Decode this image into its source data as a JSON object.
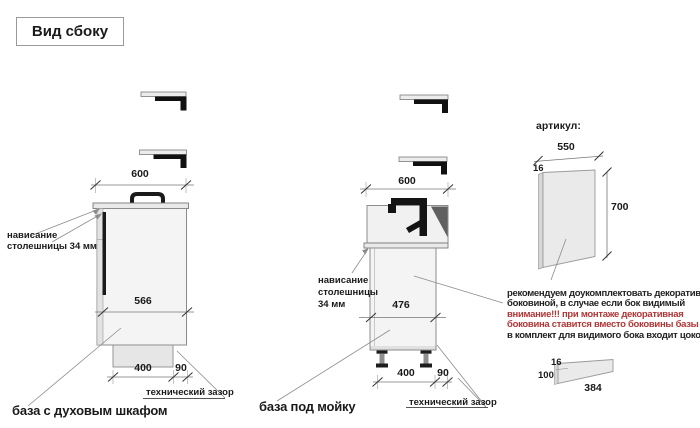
{
  "title": "Вид сбоку",
  "colors": {
    "warning_text": "#b03636",
    "drawing_outline": "#8c8c8c",
    "cabinet_fill": "#f4f4f4",
    "accent_black": "#1a1a1a"
  },
  "oven_base": {
    "label": "база с духовым шкафом",
    "dims": {
      "countertop_width": "600",
      "body_depth": "566",
      "plinth_depth": "400",
      "rear_gap": "90"
    },
    "overhang_note": {
      "line1": "нависание",
      "line2": "столешницы 34 мм"
    },
    "gap_label": "технический зазор"
  },
  "sink_base": {
    "label": "база под мойку",
    "dims": {
      "countertop_width": "600",
      "body_depth": "476",
      "plinth_depth": "400",
      "rear_gap": "90"
    },
    "overhang_note": {
      "line1": "нависание",
      "line2": "столешницы",
      "line3": "34 мм"
    },
    "gap_label": "технический зазор"
  },
  "side_panel": {
    "header": "артикул:",
    "dims": {
      "width": "550",
      "thickness": "16",
      "height": "700"
    }
  },
  "plinth_strip": {
    "dims": {
      "thickness": "16",
      "height": "100",
      "length": "384"
    }
  },
  "note": {
    "lines": [
      {
        "text": "рекомендуем доукомплектовать декоративной",
        "style": "normal"
      },
      {
        "text": "боковиной, в случае если бок видимый",
        "style": "normal"
      },
      {
        "text": "внимание!!! при монтаже декоративная",
        "style": "warning"
      },
      {
        "text": "боковина ставится вместо боковины базы лдсп",
        "style": "warning"
      },
      {
        "text": "в комплект для видимого бока входит цоколь:",
        "style": "normal"
      }
    ]
  }
}
